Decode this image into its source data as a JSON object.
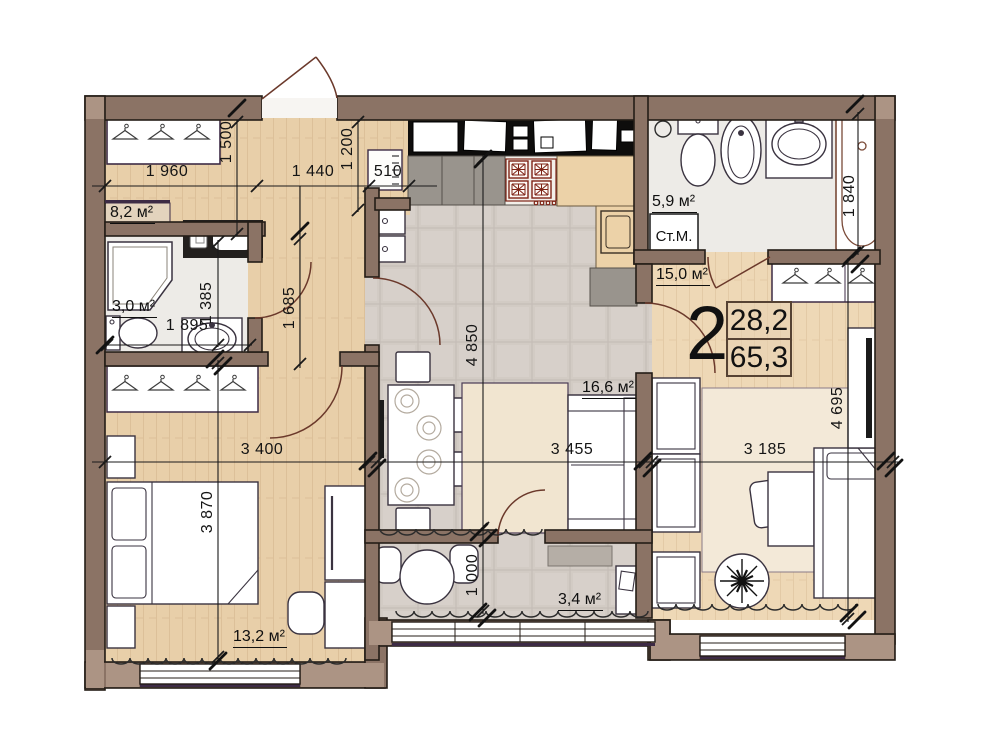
{
  "plan": {
    "unit": {
      "rooms": "2",
      "living_area": "28,2",
      "total_area": "65,3"
    },
    "areas": {
      "hallway": "8,2 м²",
      "bathroom_small": "3,0 м²",
      "bathroom_large": "5,9 м²",
      "bedroom_right": "15,0 м²",
      "kitchen_living": "16,6 м²",
      "bedroom_left": "13,2 м²",
      "balcony": "3,4 м²"
    },
    "appliances": {
      "washing_machine": "Ст.М."
    },
    "dims": {
      "hall_width": "1 960",
      "corridor_top_width": "1 440",
      "radiator_width": "510",
      "hall_depth": "1 500",
      "entry_depth": "1 200",
      "corridor_height": "1 685",
      "bath_small_depth": "1 385",
      "bath_small_width": "1 895",
      "living_depth": "4 850",
      "bathtub_length": "1 840",
      "bedroom_right_depth": "4 695",
      "bedroom_left_width": "3 400",
      "living_width": "3 455",
      "bedroom_right_width": "3 185",
      "bedroom_left_depth": "3 870",
      "balcony_depth": "1 000"
    },
    "colors": {
      "wall": "#8b7365",
      "wall_accent": "#ac9484",
      "wood_floor": "#e8cfa9",
      "wood_floor_light": "#eed8b6",
      "tile_floor": "#d2cbc4",
      "marble_floor": "#edebe7",
      "door_arc": "#6b392b"
    }
  }
}
